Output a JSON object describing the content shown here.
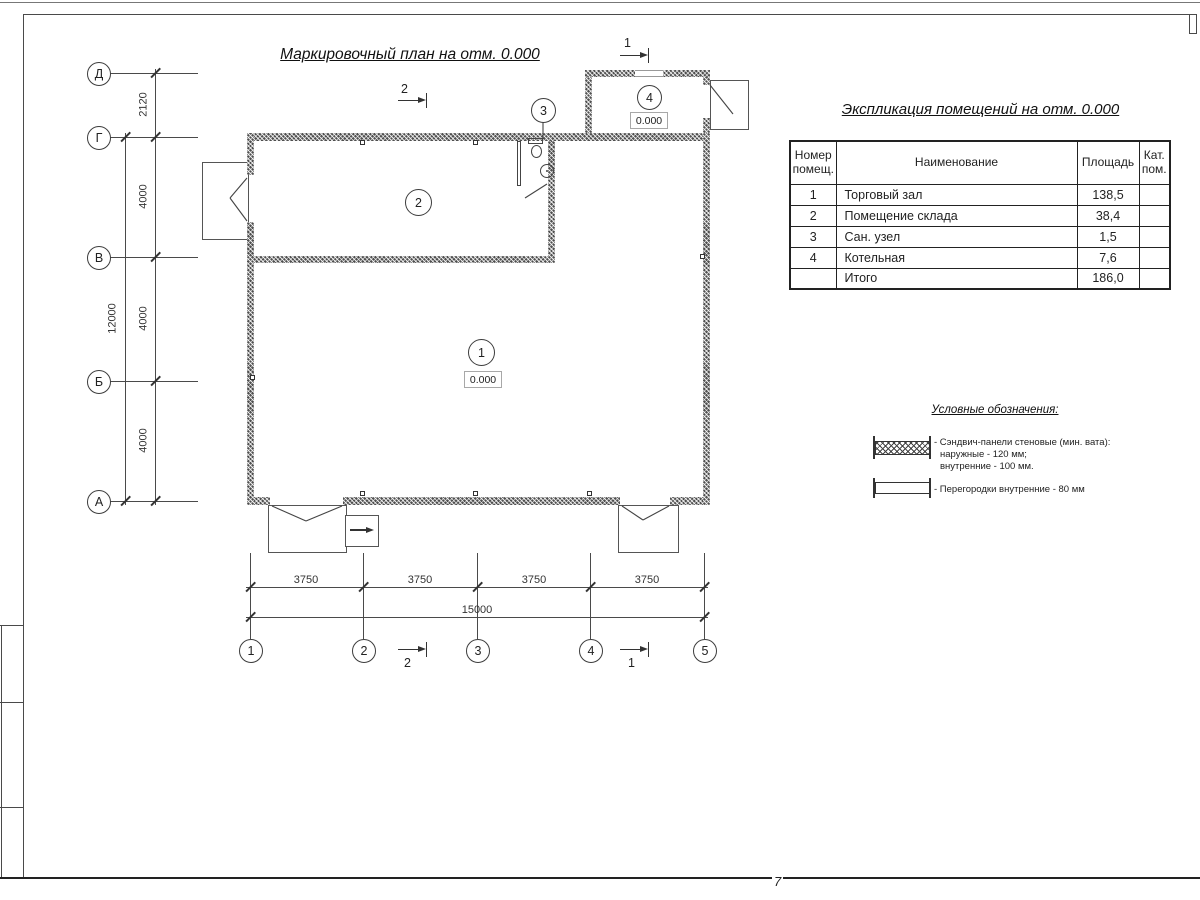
{
  "drawing": {
    "plan_title": "Маркировочный план на отм. 0.000",
    "page_number": "7"
  },
  "plan": {
    "axes_v": [
      "Д",
      "Г",
      "В",
      "Б",
      "А"
    ],
    "axes_h": [
      "1",
      "2",
      "3",
      "4",
      "5"
    ],
    "dims_left": [
      "2120",
      "4000",
      "4000",
      "4000"
    ],
    "dim_left_total": "12000",
    "dims_bottom": [
      "3750",
      "3750",
      "3750",
      "3750"
    ],
    "dim_bottom_total": "15000",
    "rooms": {
      "r1": {
        "number": "1",
        "level": "0.000"
      },
      "r2": {
        "number": "2"
      },
      "r3": {
        "number": "3"
      },
      "r4": {
        "number": "4",
        "level": "0.000"
      }
    },
    "sections": {
      "top_2": "2",
      "top_1": "1",
      "bottom_2": "2",
      "bottom_1": "1"
    }
  },
  "explication": {
    "title": "Экспликация помещений на отм. 0.000",
    "headers": {
      "number": "Номер помещ.",
      "name": "Наименование",
      "area": "Площадь",
      "category": "Кат. пом."
    },
    "rows": [
      {
        "number": "1",
        "name": "Торговый зал",
        "area": "138,5",
        "category": ""
      },
      {
        "number": "2",
        "name": "Помещение склада",
        "area": "38,4",
        "category": ""
      },
      {
        "number": "3",
        "name": "Сан. узел",
        "area": "1,5",
        "category": ""
      },
      {
        "number": "4",
        "name": "Котельная",
        "area": "7,6",
        "category": ""
      },
      {
        "number": "",
        "name": "Итого",
        "area": "186,0",
        "category": ""
      }
    ]
  },
  "legend": {
    "title": "Условные обозначения:",
    "sandwich": {
      "line1": "- Сэндвич-панели стеновые (мин. вата):",
      "line2": "наружные - 120 мм;",
      "line3": "внутренние - 100 мм."
    },
    "partition": {
      "line1": "- Перегородки внутренние - 80 мм"
    }
  }
}
